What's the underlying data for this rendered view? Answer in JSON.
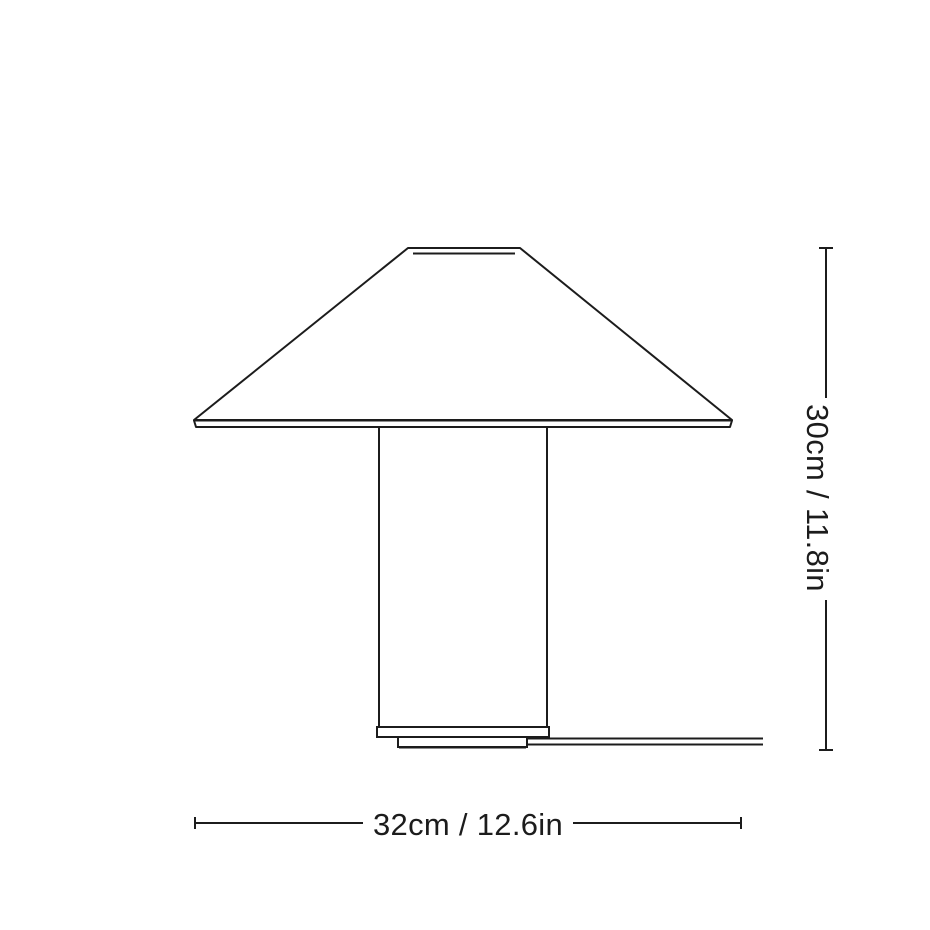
{
  "page": {
    "background": "#ffffff",
    "line_color": "#1c1c1c"
  },
  "drawing": {
    "subject": "table lamp",
    "view": "front elevation line drawing",
    "parts": [
      "shade",
      "shade-top-rim",
      "shade-bottom-rim",
      "stem",
      "base-plate",
      "foot",
      "power-cord"
    ]
  },
  "dimensions": {
    "height": {
      "label": "30cm / 11.8in",
      "value_cm": 30,
      "value_in": 11.8,
      "orientation": "vertical"
    },
    "width": {
      "label": "32cm / 12.6in",
      "value_cm": 32,
      "value_in": 12.6,
      "orientation": "horizontal"
    }
  }
}
